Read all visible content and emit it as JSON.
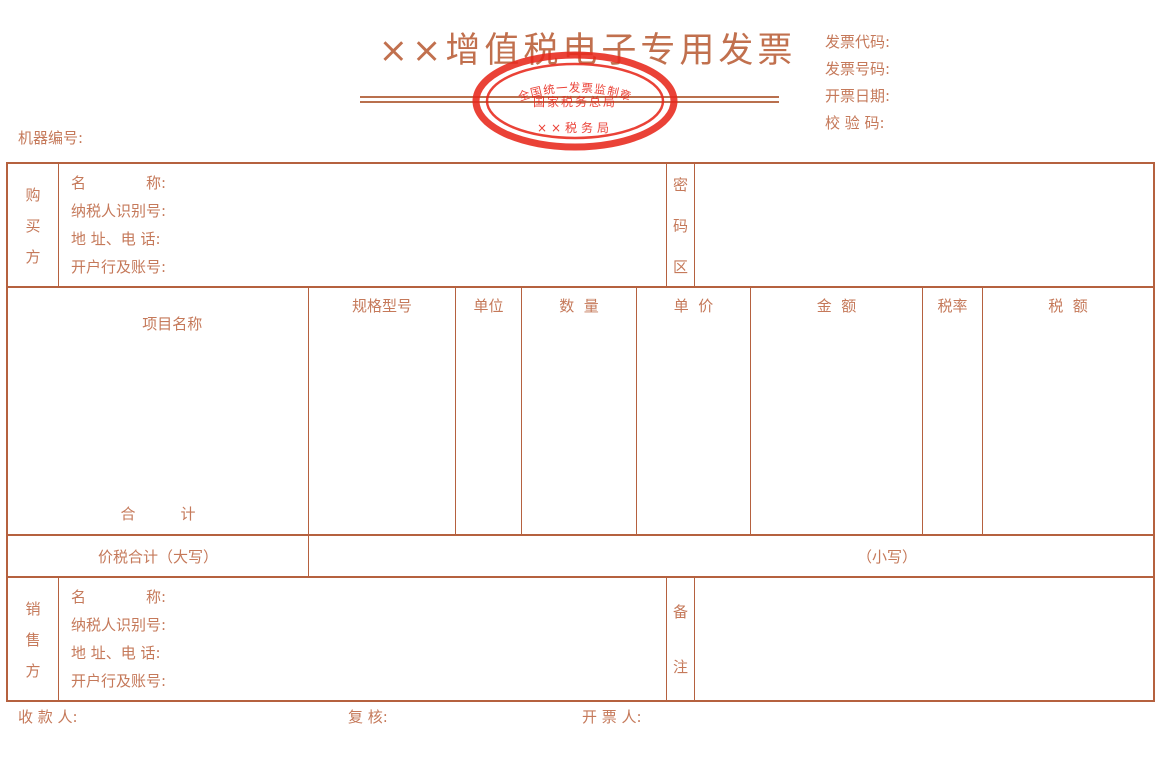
{
  "colors": {
    "ink": "#b5613f",
    "text": "#c5795a",
    "stamp_red": "#e8281c"
  },
  "header": {
    "machine_no_label": "机器编号:",
    "title": "××增值税电子专用发票",
    "meta": {
      "invoice_code_label": "发票代码:",
      "invoice_number_label": "发票号码:",
      "invoice_date_label": "开票日期:",
      "check_code_label": "校 验 码:"
    },
    "stamp": {
      "arc_text": "全国统一发票监制章",
      "center_text": "国家税务总局",
      "bottom_text": "××税务局"
    }
  },
  "buyer": {
    "side_label": "购买方",
    "fields": [
      "名　　　　称:",
      "纳税人识别号:",
      "地 址、电 话:",
      "开户行及账号:"
    ],
    "password_area_label": "密码区"
  },
  "items": {
    "columns": [
      "项目名称",
      "规格型号",
      "单位",
      "数  量",
      "单  价",
      "金  额",
      "税率",
      "税  额"
    ],
    "total_label": "合　　　计"
  },
  "total_row": {
    "amount_in_words_label": "价税合计（大写）",
    "amount_in_figures_label": "（小写）"
  },
  "seller": {
    "side_label": "销售方",
    "fields": [
      "名　　　　称:",
      "纳税人识别号:",
      "地 址、电 话:",
      "开户行及账号:"
    ],
    "remarks_label": "备注"
  },
  "footer": {
    "payee_label": "收 款 人:",
    "reviewer_label": "复 核:",
    "drawer_label": "开 票 人:"
  }
}
